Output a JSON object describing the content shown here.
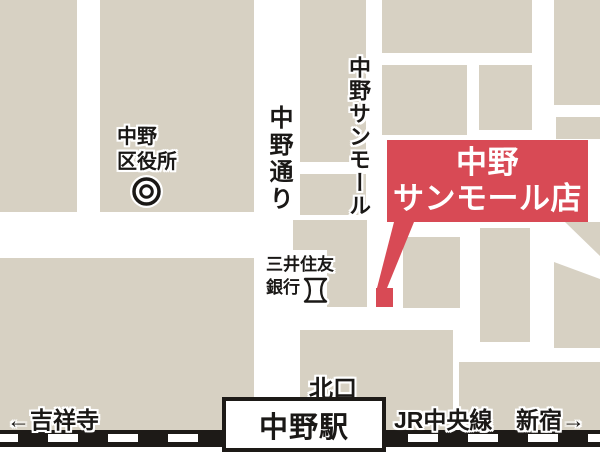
{
  "colors": {
    "building": "#d7d1c3",
    "accent_red": "#d84a55",
    "rail_black": "#1d1a17",
    "label": "#1a1816"
  },
  "labels": {
    "ward_office_line1": "中野",
    "ward_office_line2": "区役所",
    "nakano_dori": "中野通り",
    "sunmall_street": "中野サンモール",
    "store_line1": "中野",
    "store_line2": "サンモール店",
    "bank_line1": "三井住友",
    "bank_line2": "銀行",
    "north_exit": "北口",
    "station": "中野駅",
    "dest_left": "←吉祥寺",
    "jr_line": "JR中央線",
    "dest_right": "新宿→"
  },
  "icons": {
    "ward_office": "double-circle-map-symbol",
    "bank": "bank-fundo-map-symbol",
    "store_marker": "red-square-with-pointer"
  }
}
